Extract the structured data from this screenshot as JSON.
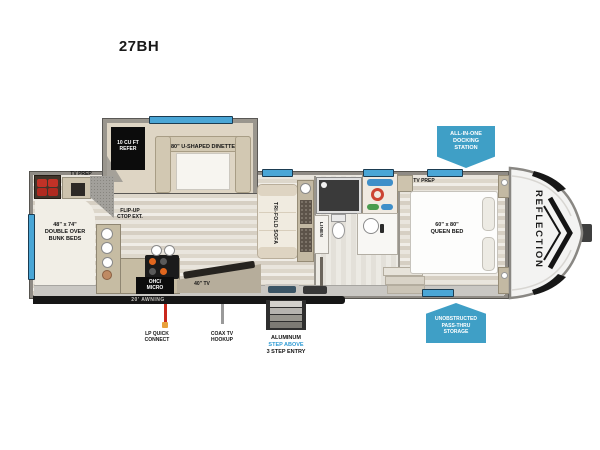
{
  "title": "27BH",
  "brand": "REFLECTION",
  "badges": {
    "docking": [
      "ALL-IN-ONE",
      "DOCKING",
      "STATION"
    ],
    "passthru": [
      "UNOBSTRUCTED",
      "PASS-THRU",
      "STORAGE"
    ]
  },
  "labels": {
    "refer": [
      "10 CU FT",
      "REFER"
    ],
    "dinette": "80\" U-SHAPED DINETTE",
    "tv_prep_rear": "TV PREP",
    "bunks": [
      "48\" x 74\"",
      "DOUBLE OVER",
      "BUNK BEDS"
    ],
    "flip_up": [
      "FLIP-UP",
      "CTOP EXT."
    ],
    "ohc_micro": [
      "OHC/",
      "MICRO"
    ],
    "tv_40": "40\" TV",
    "sofa": "TRI-FOLD SOFA",
    "linen": "LINEN",
    "tv_prep_bedroom": "TV PREP",
    "queen_bed": [
      "60\" x 80\"",
      "QUEEN BED"
    ],
    "awning": "20' AWNING",
    "lp_quick_connect": [
      "LP QUICK",
      "CONNECT"
    ],
    "coax_hookup": [
      "COAX TV",
      "HOOKUP"
    ],
    "entry_steps": [
      "ALUMINUM",
      "STEP ABOVE",
      "3 STEP ENTRY"
    ]
  },
  "colors": {
    "window_blue": "#4aa6d6",
    "badge_blue": "#3f9fc6",
    "awning_black": "#161616",
    "lp_red": "#c9281c",
    "coax_gray": "#9a9a9a",
    "step_blue": "#2f9bd4",
    "refer_black": "#0c0c0c"
  }
}
